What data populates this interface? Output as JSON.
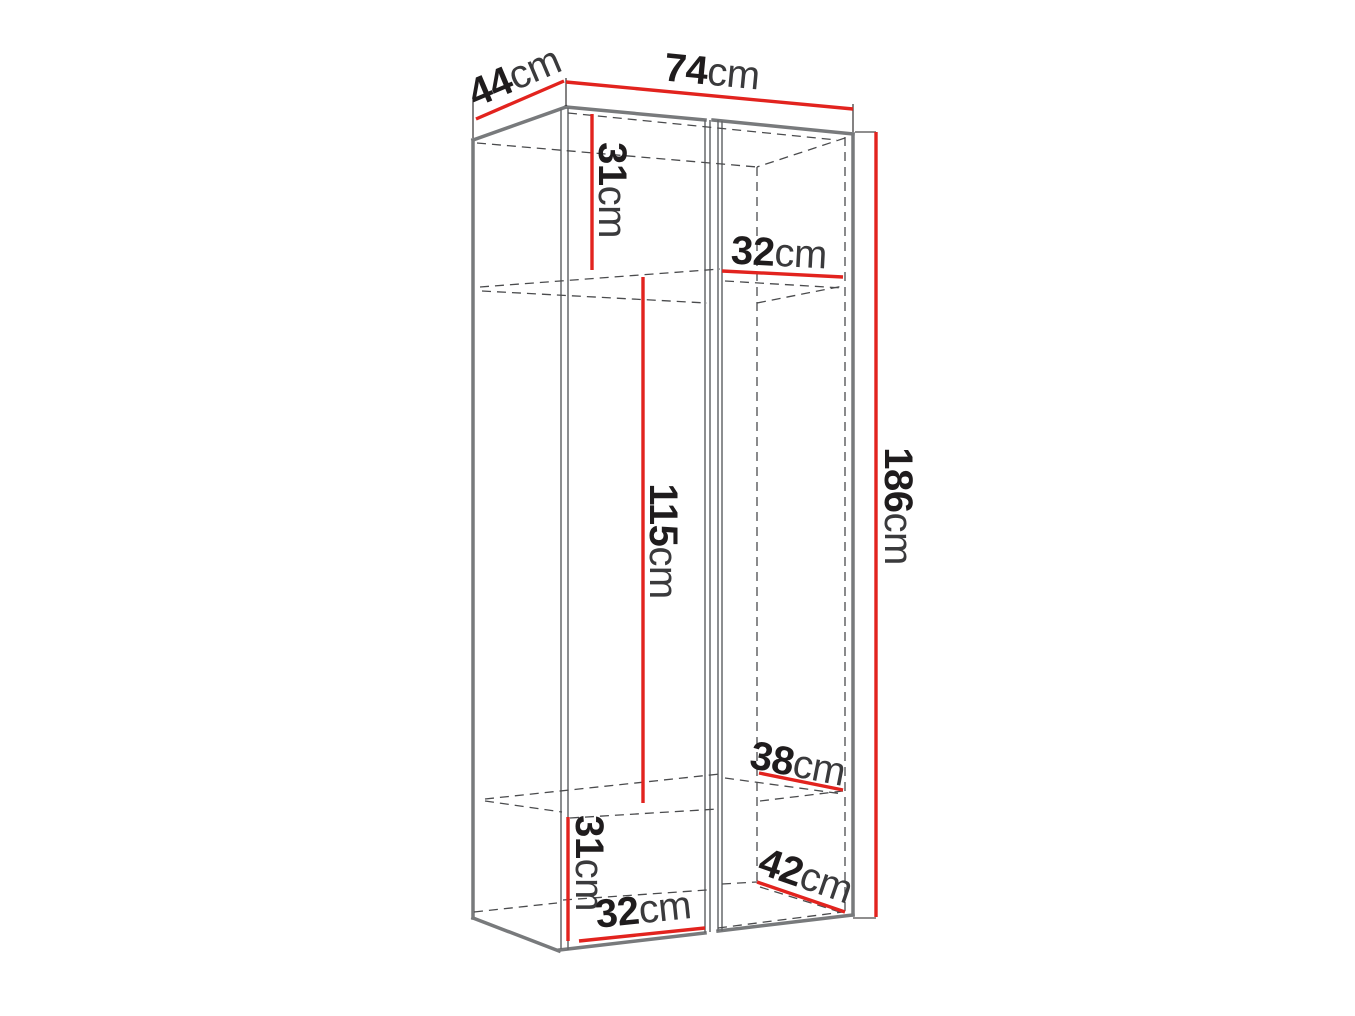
{
  "diagram": {
    "type": "furniture-dimension-drawing",
    "subject": "tall two-door wardrobe cabinet shown in perspective with hidden interior shelves (dashed) and red dimension lines",
    "unit": "cm",
    "total_dimensions": {
      "width_cm": 74,
      "depth_cm": 44,
      "height_cm": 186
    }
  },
  "labels": {
    "depth_top": {
      "value": "44",
      "unit": "cm"
    },
    "width_top": {
      "value": "74",
      "unit": "cm"
    },
    "upper_section_height": {
      "value": "31",
      "unit": "cm"
    },
    "upper_shelf_width": {
      "value": "32",
      "unit": "cm"
    },
    "middle_section_height": {
      "value": "115",
      "unit": "cm"
    },
    "total_height": {
      "value": "186",
      "unit": "cm"
    },
    "lower_shelf_depth": {
      "value": "38",
      "unit": "cm"
    },
    "lower_section_height": {
      "value": "31",
      "unit": "cm"
    },
    "bottom_width": {
      "value": "32",
      "unit": "cm"
    },
    "bottom_depth": {
      "value": "42",
      "unit": "cm"
    }
  },
  "colors": {
    "background": "#ffffff",
    "dimension_red": "#e2231e",
    "outline_gray": "#787a7c",
    "thin_edge_gray": "#67686b",
    "hidden_edge_gray": "#4a4b4d",
    "number_ink": "#1f1c1d",
    "unit_ink": "#3a3a3c"
  }
}
